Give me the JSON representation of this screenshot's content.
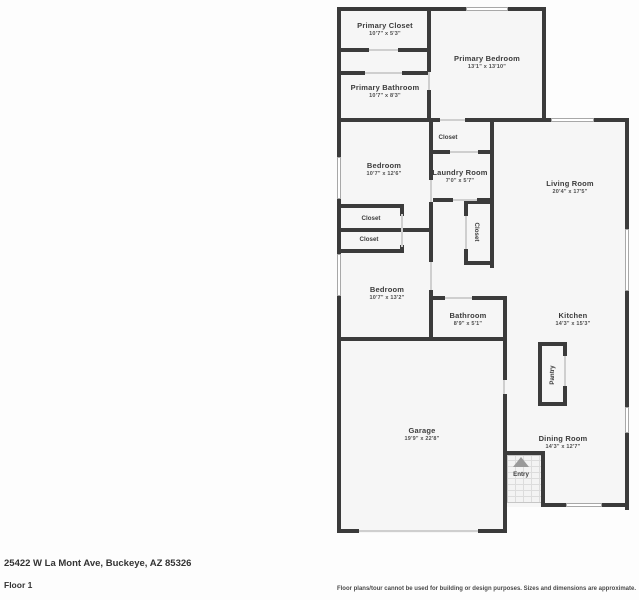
{
  "colors": {
    "wall": "#3b3b3b",
    "room_fill": "#f6f6f6",
    "door_opening": "#cfcfcf",
    "window_border": "#a8a8a8",
    "text": "#3c3c3c"
  },
  "rooms": {
    "primary_closet": {
      "name": "Primary Closet",
      "dims": "10'7\" x 5'3\""
    },
    "primary_bedroom": {
      "name": "Primary Bedroom",
      "dims": "13'1\" x 13'10\""
    },
    "primary_bathroom": {
      "name": "Primary Bathroom",
      "dims": "10'7\" x 8'3\""
    },
    "bedroom1": {
      "name": "Bedroom",
      "dims": "10'7\" x 12'6\""
    },
    "laundry": {
      "name": "Laundry Room",
      "dims": "7'0\" x 5'7\""
    },
    "living": {
      "name": "Living Room",
      "dims": "20'4\" x 17'5\""
    },
    "bedroom2": {
      "name": "Bedroom",
      "dims": "10'7\" x 13'2\""
    },
    "bathroom": {
      "name": "Bathroom",
      "dims": "8'9\" x 5'1\""
    },
    "kitchen": {
      "name": "Kitchen",
      "dims": "14'3\" x 15'3\""
    },
    "garage": {
      "name": "Garage",
      "dims": "19'9\" x 22'8\""
    },
    "dining": {
      "name": "Dining Room",
      "dims": "14'3\" x 12'7\""
    }
  },
  "labels": {
    "closet_top": "Closet",
    "closet_a": "Closet",
    "closet_b": "Closet",
    "closet_hall": "Closet",
    "pantry": "Pantry",
    "entry": "Entry"
  },
  "footer": {
    "address": "25422 W La Mont Ave, Buckeye, AZ 85326",
    "floor": "Floor 1",
    "disclaimer": "Floor plans/tour cannot be used for building or design purposes. Sizes and dimensions are approximate."
  }
}
